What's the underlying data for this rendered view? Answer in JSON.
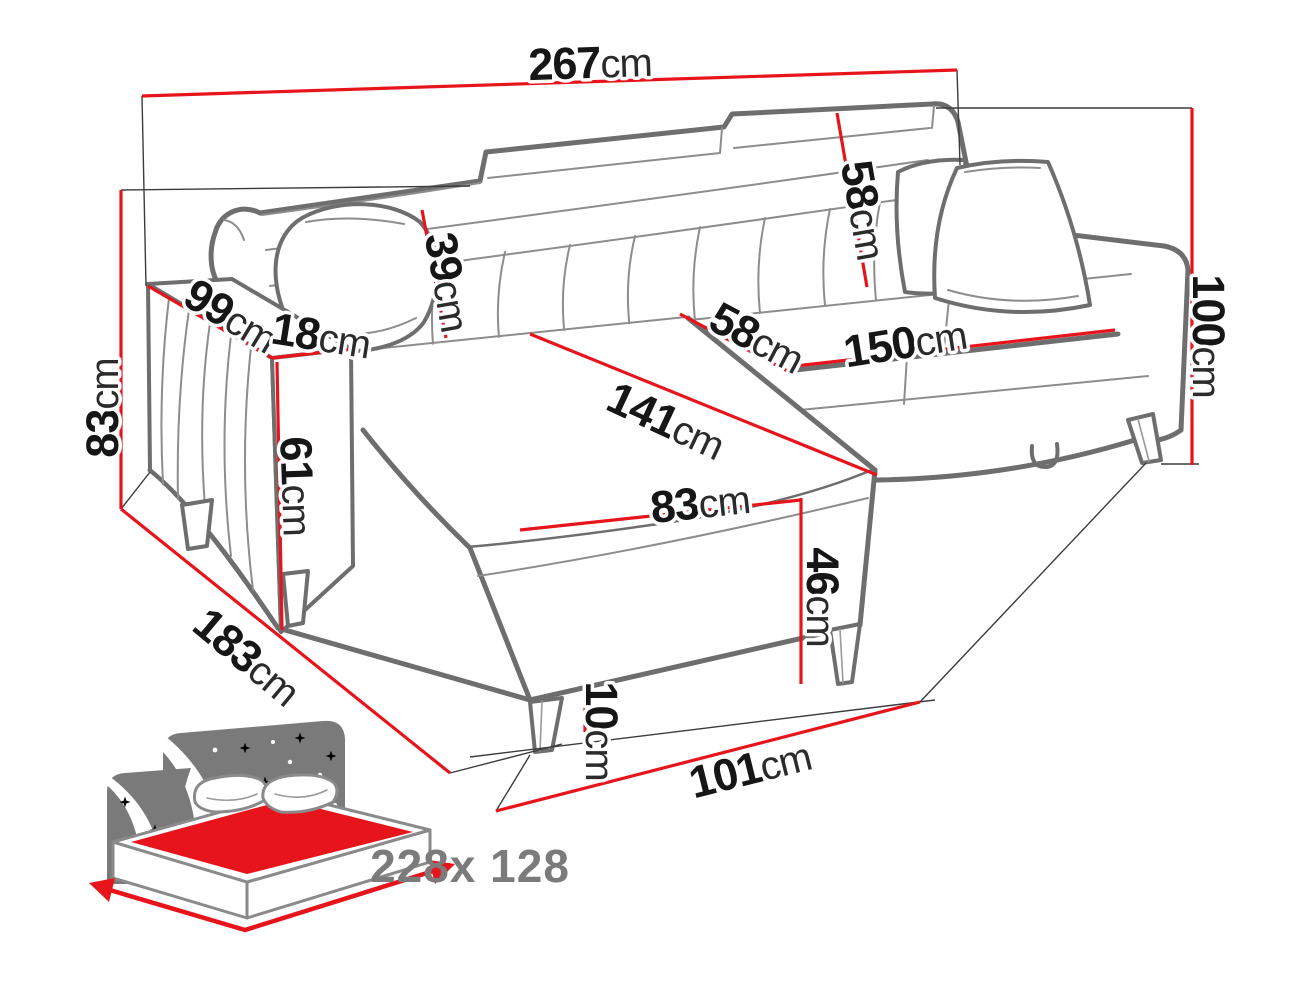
{
  "diagram": {
    "type": "furniture-dimension-diagram",
    "subject": "corner sofa bed with chaise",
    "unit_default": "cm",
    "colors": {
      "dimension_line": "#e8141c",
      "sofa_outline": "#6e6e6e",
      "label_text": "#161616",
      "icon_gray": "#7a7a7a"
    },
    "dimensions": [
      {
        "id": "total-width",
        "value": "267",
        "unit": "cm"
      },
      {
        "id": "backrest-height-right",
        "value": "58",
        "unit": "cm"
      },
      {
        "id": "backrest-height-left",
        "value": "39",
        "unit": "cm"
      },
      {
        "id": "armrest-depth",
        "value": "99",
        "unit": "cm"
      },
      {
        "id": "armrest-width",
        "value": "18",
        "unit": "cm"
      },
      {
        "id": "side-height-left",
        "value": "83",
        "unit": "cm"
      },
      {
        "id": "total-height",
        "value": "100",
        "unit": "cm"
      },
      {
        "id": "armrest-front-height",
        "value": "61",
        "unit": "cm"
      },
      {
        "id": "chaise-seat-width",
        "value": "58",
        "unit": "cm"
      },
      {
        "id": "seat-front-width",
        "value": "150",
        "unit": "cm"
      },
      {
        "id": "chaise-length",
        "value": "141",
        "unit": "cm"
      },
      {
        "id": "chaise-front-width",
        "value": "83",
        "unit": "cm"
      },
      {
        "id": "base-height",
        "value": "46",
        "unit": "cm"
      },
      {
        "id": "total-depth-left",
        "value": "183",
        "unit": "cm"
      },
      {
        "id": "leg-height",
        "value": "10",
        "unit": "cm"
      },
      {
        "id": "right-side-depth",
        "value": "101",
        "unit": "cm"
      }
    ],
    "sleeping_area": {
      "label": "228x 128",
      "icon": "sofa-bed-sleeping-area-icon"
    }
  }
}
